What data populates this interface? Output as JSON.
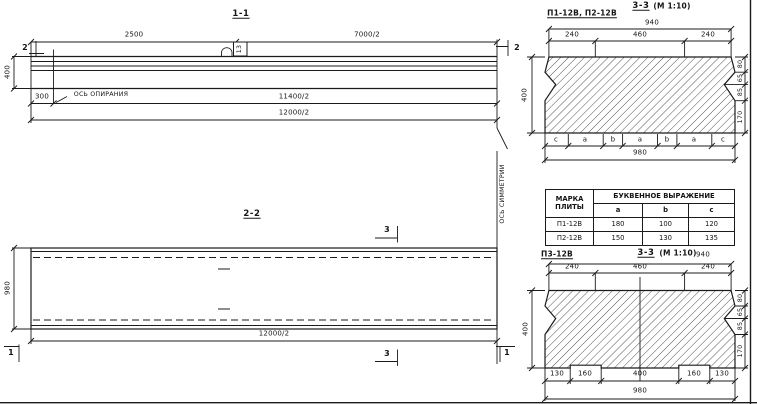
{
  "drawing": {
    "view_1_1": {
      "title": "1-1",
      "dims": {
        "d2500": "2500",
        "d7000": "7000/2",
        "d400": "400",
        "d300": "300",
        "d11400": "11400/2",
        "d12000": "12000/2"
      },
      "labels": {
        "support_axis": "ОСЬ ОПИРАНИЯ",
        "loop_ref": "13"
      },
      "markers": {
        "left": "2",
        "right": "2"
      }
    },
    "view_2_2": {
      "title": "2-2",
      "dims": {
        "d980": "980",
        "d12000": "12000/2"
      },
      "labels": {
        "symmetry_axis": "ОСЬ СИММЕТРИИ"
      },
      "markers": {
        "section3_top": "3",
        "section3_bottom": "3",
        "corner1_left": "1",
        "corner1_right": "1"
      }
    },
    "section_a": {
      "subtitle": "П1-12В, П2-12В",
      "title": "3-3",
      "scale": "(М 1:10)",
      "dims": {
        "top": "940",
        "t240l": "240",
        "t460": "460",
        "t240r": "240",
        "left": "400",
        "r80": "80",
        "r65": "65",
        "r85": "85",
        "r170": "170",
        "bottom": "980"
      },
      "letters": [
        "c",
        "a",
        "b",
        "a",
        "b",
        "a",
        "c"
      ]
    },
    "section_b": {
      "subtitle": "П3-12В",
      "title": "3-3",
      "scale": "(М 1:10)",
      "dims": {
        "top": "940",
        "t240l": "240",
        "t460": "460",
        "t240r": "240",
        "left": "400",
        "r80": "80",
        "r65": "65",
        "r85": "85",
        "r170": "170",
        "b130l": "130",
        "b160l": "160",
        "b400": "400",
        "b160r": "160",
        "b130r": "130",
        "bottom": "980"
      }
    },
    "table": {
      "header_marka": "МАРКА ПЛИТЫ",
      "header_expr": "БУКВЕННОЕ ВЫРАЖЕНИЕ",
      "subheaders": [
        "a",
        "b",
        "c"
      ],
      "rows": [
        {
          "marka": "П1-12В",
          "a": "180",
          "b": "100",
          "c": "120"
        },
        {
          "marka": "П2-12В",
          "a": "150",
          "b": "130",
          "c": "135"
        }
      ]
    },
    "colors": {
      "line": "#1b1b1b",
      "bg": "#ffffff"
    }
  }
}
